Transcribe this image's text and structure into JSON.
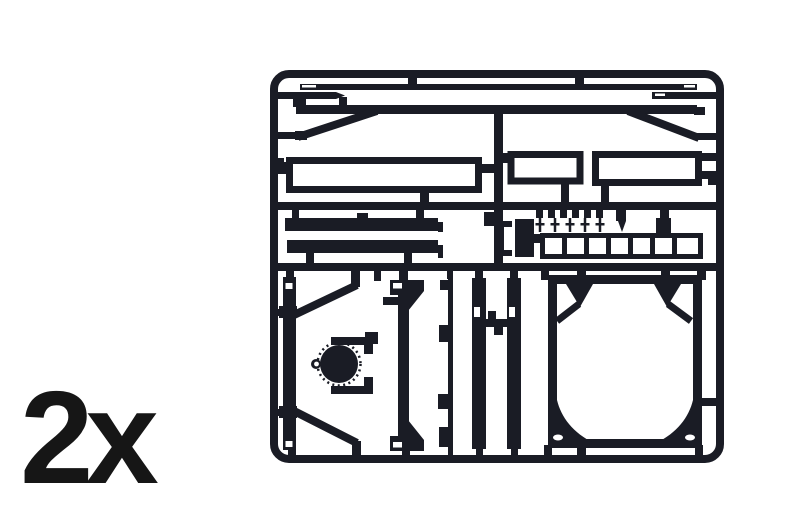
{
  "quantity_label": "2x",
  "colors": {
    "plastic": "#1a1c25",
    "background": "#ffffff",
    "label_text": "#161616"
  },
  "sprue": {
    "description": "injection-molded model-kit parts sprue, dark plastic on white background, shown as required twice",
    "sections": {
      "top_row": [
        "long thin strip with notched ends",
        "short strip with pointed tip (left)",
        "short notched strip (right)",
        "long flat bar",
        "left diagonal brace",
        "right diagonal brace",
        "large open rectangle panel",
        "medium open rectangle panel",
        "wide open rectangle panel"
      ],
      "middle_row": [
        "two solid flat bars",
        "clip bracket",
        "solid block",
        "row of small pins",
        "ladder strip with rungs"
      ],
      "bottom_row": [
        "notched vertical beam",
        "two diagonal struts",
        "toothed wheel with yoke bracket",
        "vertical panel with angled end caps",
        "thin rod with lugs",
        "two notched vertical bars with bridge",
        "large rectangular frame with corner braces and gusset holes"
      ]
    }
  }
}
